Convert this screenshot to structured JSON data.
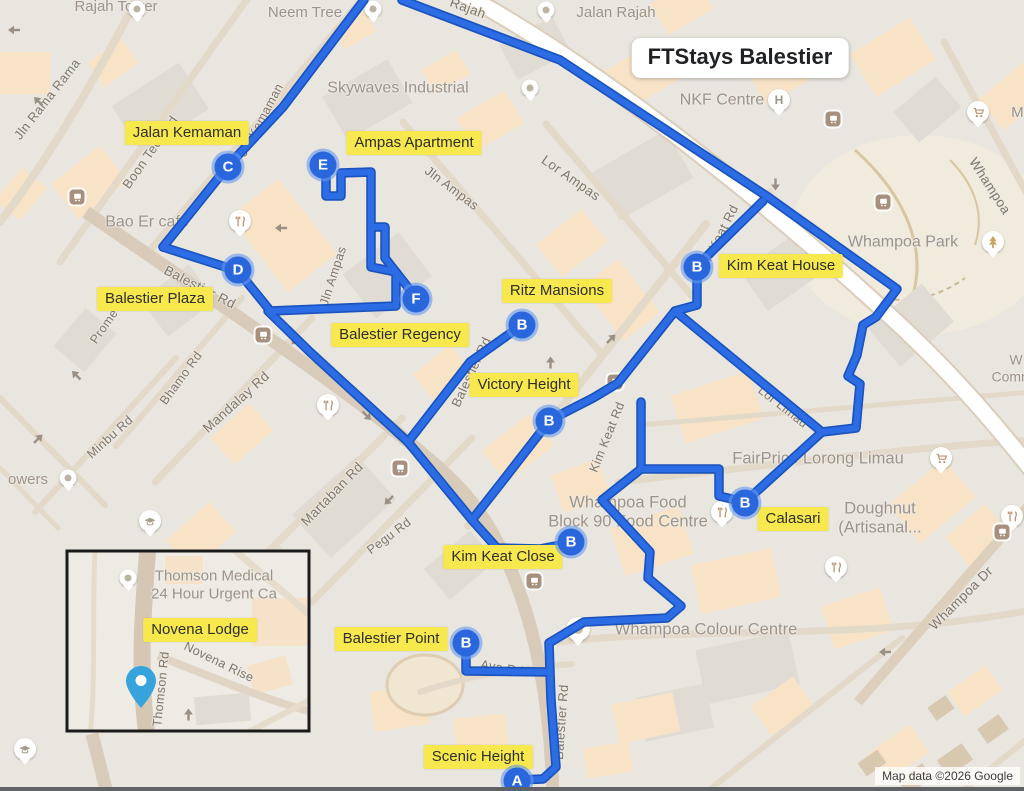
{
  "title": "FTStays Balestier",
  "attribution": "Map data ©2026 Google",
  "colors": {
    "route": "#2C6CE4",
    "route_casing": "#1A53BD",
    "marker": "#2A66DC",
    "marker_ring": "rgba(100,152,240,0.6)",
    "highlight_bg": "#F7E84D",
    "highlight_text": "#2F2E29",
    "inset_pin": "#37A3DC"
  },
  "routes": [
    {
      "name": "route-boon-teck",
      "points": "364,0 283,107 228,166 163,247"
    },
    {
      "name": "route-kemaman-ampas-loop",
      "points": "163,247 238,271 268,308 270,311 396,306 396,272 371,267 371,172 341,173 341,196 326,196 326,176"
    },
    {
      "name": "route-balestier-regency-spur",
      "points": "371,227 385,227 385,258 414,295"
    },
    {
      "name": "route-balestier-rd",
      "points": "268,311 310,352 408,442"
    },
    {
      "name": "route-ritz-loop",
      "points": "522,325 470,362 408,442 472,520 497,548 540,549 571,543"
    },
    {
      "name": "route-jalan-rajah",
      "points": "402,0 560,60 768,197 897,289 876,317 863,325 857,355 848,376 860,384 856,428 822,432 745,502"
    },
    {
      "name": "route-kim-keat-rd",
      "points": "763,201 697,266 697,305 675,311 618,383 593,398 550,420 505,478 472,520"
    },
    {
      "name": "route-lor-limau",
      "points": "675,311 822,432"
    },
    {
      "name": "route-calasari-connector",
      "points": "745,502 719,496 719,469 641,469 641,402"
    },
    {
      "name": "route-whampoa-colour-a",
      "points": "641,469 602,500 650,552 648,578 681,606 667,618 584,622 549,643 551,700 556,767 543,779 517,780"
    },
    {
      "name": "route-balestier-point-spur",
      "points": "466,643 466,671 549,672"
    }
  ],
  "markers": [
    {
      "letter": "A",
      "x": 517,
      "y": 781,
      "name": "marker-a-scenic-height"
    },
    {
      "letter": "B",
      "x": 466,
      "y": 643,
      "name": "marker-b-balestier-point"
    },
    {
      "letter": "B",
      "x": 571,
      "y": 542,
      "name": "marker-b-kim-keat-close"
    },
    {
      "letter": "B",
      "x": 549,
      "y": 421,
      "name": "marker-b-victory-height"
    },
    {
      "letter": "B",
      "x": 522,
      "y": 325,
      "name": "marker-b-ritz-mansions"
    },
    {
      "letter": "B",
      "x": 697,
      "y": 267,
      "name": "marker-b-kim-keat-house"
    },
    {
      "letter": "B",
      "x": 745,
      "y": 503,
      "name": "marker-b-calasari"
    },
    {
      "letter": "C",
      "x": 228,
      "y": 167,
      "name": "marker-c-jalan-kemaman"
    },
    {
      "letter": "D",
      "x": 238,
      "y": 270,
      "name": "marker-d-balestier-plaza"
    },
    {
      "letter": "E",
      "x": 323,
      "y": 165,
      "name": "marker-e-ampas-apartment"
    },
    {
      "letter": "F",
      "x": 416,
      "y": 299,
      "name": "marker-f-balestier-regency"
    }
  ],
  "property_labels": [
    {
      "text": "Jalan Kemaman",
      "x": 187,
      "y": 133
    },
    {
      "text": "Ampas Apartment",
      "x": 414,
      "y": 143
    },
    {
      "text": "Kim Keat House",
      "x": 781,
      "y": 266
    },
    {
      "text": "Balestier Plaza",
      "x": 155,
      "y": 299
    },
    {
      "text": "Ritz Mansions",
      "x": 557,
      "y": 291
    },
    {
      "text": "Balestier Regency",
      "x": 400,
      "y": 335
    },
    {
      "text": "Victory Height",
      "x": 524,
      "y": 385
    },
    {
      "text": "Kim Keat Close",
      "x": 503,
      "y": 557
    },
    {
      "text": "Calasari",
      "x": 793,
      "y": 519
    },
    {
      "text": "Novena Lodge",
      "x": 200,
      "y": 630
    },
    {
      "text": "Balestier Point",
      "x": 391,
      "y": 639
    },
    {
      "text": "Scenic Height",
      "x": 478,
      "y": 757
    }
  ],
  "poi_labels": [
    {
      "text": "Rajah Tower",
      "x": 116,
      "y": 7,
      "size": 15
    },
    {
      "text": "Neem Tree",
      "x": 305,
      "y": 13,
      "size": 15
    },
    {
      "text": "Jalan Rajah",
      "x": 616,
      "y": 13,
      "size": 15
    },
    {
      "text": "Skywaves Industrial",
      "x": 398,
      "y": 89,
      "size": 16
    },
    {
      "text": "NKF Centre",
      "x": 722,
      "y": 101,
      "size": 16
    },
    {
      "text": "Whampoa Park",
      "x": 903,
      "y": 243,
      "size": 16
    },
    {
      "text": "Bao Er cafe",
      "x": 147,
      "y": 223,
      "size": 16
    },
    {
      "text": "owers",
      "x": 28,
      "y": 480,
      "size": 15
    },
    {
      "text": "FairPrice Lorong Limau",
      "x": 818,
      "y": 459,
      "size": 16.5
    },
    {
      "lines": [
        "Whampoa Food",
        "Block 90 Food Centre"
      ],
      "x": 628,
      "y": 513,
      "size": 16.5
    },
    {
      "lines": [
        "Doughnut",
        "(Artisanal..."
      ],
      "x": 880,
      "y": 519,
      "size": 16.5
    },
    {
      "text": "Whampoa Colour Centre",
      "x": 706,
      "y": 630,
      "size": 16.5
    },
    {
      "lines": [
        "W",
        "Commu"
      ],
      "x": 1016,
      "y": 368,
      "size": 14
    },
    {
      "text": "Mi",
      "x": 1019,
      "y": 113,
      "size": 15
    },
    {
      "lines": [
        "Thomson Medical",
        "24 Hour Urgent Ca"
      ],
      "x": 214,
      "y": 585,
      "size": 15
    }
  ],
  "street_labels": [
    {
      "text": "Jln Rama Rama",
      "x": 47,
      "y": 99,
      "rot": -52,
      "size": 13
    },
    {
      "text": "Boon Teck Rd",
      "x": 150,
      "y": 152,
      "rot": -55,
      "size": 13
    },
    {
      "text": "Jln Kemaman",
      "x": 261,
      "y": 120,
      "rot": -62,
      "size": 12.5
    },
    {
      "text": "Rajah",
      "x": 468,
      "y": 8,
      "rot": 20,
      "size": 13.5
    },
    {
      "text": "Balestier Rd",
      "x": 200,
      "y": 287,
      "rot": 27,
      "size": 13.5
    },
    {
      "text": "Balestier Rd",
      "x": 471,
      "y": 372,
      "rot": -65,
      "size": 13
    },
    {
      "text": "Balestier Rd",
      "x": 561,
      "y": 722,
      "rot": -86,
      "size": 13
    },
    {
      "text": "Bhamo Rd",
      "x": 181,
      "y": 378,
      "rot": -54,
      "size": 12.5
    },
    {
      "text": "Mandalay Rd",
      "x": 236,
      "y": 402,
      "rot": -42,
      "size": 13.5
    },
    {
      "text": "Minbu Rd",
      "x": 110,
      "y": 437,
      "rot": -42,
      "size": 12.5
    },
    {
      "text": "Prome Rd",
      "x": 110,
      "y": 318,
      "rot": -55,
      "size": 12.5
    },
    {
      "text": "Martaban Rd",
      "x": 332,
      "y": 494,
      "rot": -46,
      "size": 13.5
    },
    {
      "text": "Pegu Rd",
      "x": 389,
      "y": 536,
      "rot": -37,
      "size": 12.5
    },
    {
      "text": "Jln Ampas",
      "x": 452,
      "y": 188,
      "rot": 37,
      "size": 13
    },
    {
      "text": "Lor Ampas",
      "x": 571,
      "y": 178,
      "rot": 35,
      "size": 13.5
    },
    {
      "text": "Jln Ampas",
      "x": 333,
      "y": 276,
      "rot": -72,
      "size": 12.5
    },
    {
      "text": "Kim Keat Rd",
      "x": 717,
      "y": 240,
      "rot": -63,
      "size": 13
    },
    {
      "text": "Kim Keat Rd",
      "x": 607,
      "y": 437,
      "rot": -68,
      "size": 12.5
    },
    {
      "text": "Lor Limau",
      "x": 783,
      "y": 407,
      "rot": 38,
      "size": 12.5
    },
    {
      "text": "Whampoa Dr",
      "x": 961,
      "y": 598,
      "rot": -45,
      "size": 13.5
    },
    {
      "text": "Whampoa",
      "x": 990,
      "y": 186,
      "rot": 57,
      "size": 13.5
    },
    {
      "text": "Ava Rd",
      "x": 502,
      "y": 668,
      "rot": 10,
      "size": 12.5
    },
    {
      "text": "Novena Rise",
      "x": 219,
      "y": 662,
      "rot": 26,
      "size": 12.5
    },
    {
      "text": "Thomson Rd",
      "x": 161,
      "y": 689,
      "rot": -84,
      "size": 12.5
    }
  ],
  "icons": [
    {
      "type": "pin",
      "x": 137,
      "y": 9
    },
    {
      "type": "pin",
      "x": 373,
      "y": 9
    },
    {
      "type": "pin",
      "x": 546,
      "y": 10
    },
    {
      "type": "pin",
      "x": 530,
      "y": 88
    },
    {
      "type": "hospital",
      "x": 779,
      "y": 100
    },
    {
      "type": "tree",
      "x": 993,
      "y": 242
    },
    {
      "type": "restaurant",
      "x": 240,
      "y": 221
    },
    {
      "type": "pin",
      "x": 68,
      "y": 478
    },
    {
      "type": "cart",
      "x": 978,
      "y": 112
    },
    {
      "type": "cart",
      "x": 941,
      "y": 458
    },
    {
      "type": "restaurant",
      "x": 1012,
      "y": 516
    },
    {
      "type": "restaurant",
      "x": 722,
      "y": 512
    },
    {
      "type": "restaurant",
      "x": 836,
      "y": 567
    },
    {
      "type": "restaurant",
      "x": 328,
      "y": 405
    },
    {
      "type": "grad",
      "x": 150,
      "y": 521
    },
    {
      "type": "grad",
      "x": 25,
      "y": 749
    },
    {
      "type": "pin-large",
      "x": 578,
      "y": 629
    },
    {
      "type": "pin",
      "x": 128,
      "y": 578
    },
    {
      "type": "bus",
      "x": 77,
      "y": 197
    },
    {
      "type": "bus",
      "x": 833,
      "y": 119
    },
    {
      "type": "bus",
      "x": 883,
      "y": 202
    },
    {
      "type": "bus",
      "x": 263,
      "y": 335
    },
    {
      "type": "bus",
      "x": 400,
      "y": 468
    },
    {
      "type": "bus",
      "x": 615,
      "y": 382
    },
    {
      "type": "bus",
      "x": 534,
      "y": 581
    },
    {
      "type": "bus",
      "x": 1002,
      "y": 532
    },
    {
      "type": "arrow",
      "x": 14,
      "y": 25,
      "rot": 180
    },
    {
      "type": "arrow",
      "x": 40,
      "y": 97,
      "rot": 225
    },
    {
      "type": "arrow",
      "x": 281,
      "y": 223,
      "rot": 180
    },
    {
      "type": "arrow",
      "x": 294,
      "y": 336,
      "rot": 135
    },
    {
      "type": "arrow",
      "x": 78,
      "y": 371,
      "rot": 225
    },
    {
      "type": "arrow",
      "x": 40,
      "y": 438,
      "rot": 315
    },
    {
      "type": "arrow",
      "x": 365,
      "y": 415,
      "rot": 45
    },
    {
      "type": "arrow",
      "x": 387,
      "y": 496,
      "rot": 135
    },
    {
      "type": "arrow",
      "x": 613,
      "y": 338,
      "rot": -45
    },
    {
      "type": "arrow",
      "x": 553,
      "y": 360,
      "rot": -90
    },
    {
      "type": "arrow",
      "x": 773,
      "y": 182,
      "rot": 90
    },
    {
      "type": "arrow",
      "x": 885,
      "y": 647,
      "rot": 180
    },
    {
      "type": "arrow",
      "x": 191,
      "y": 712,
      "rot": -90
    }
  ]
}
